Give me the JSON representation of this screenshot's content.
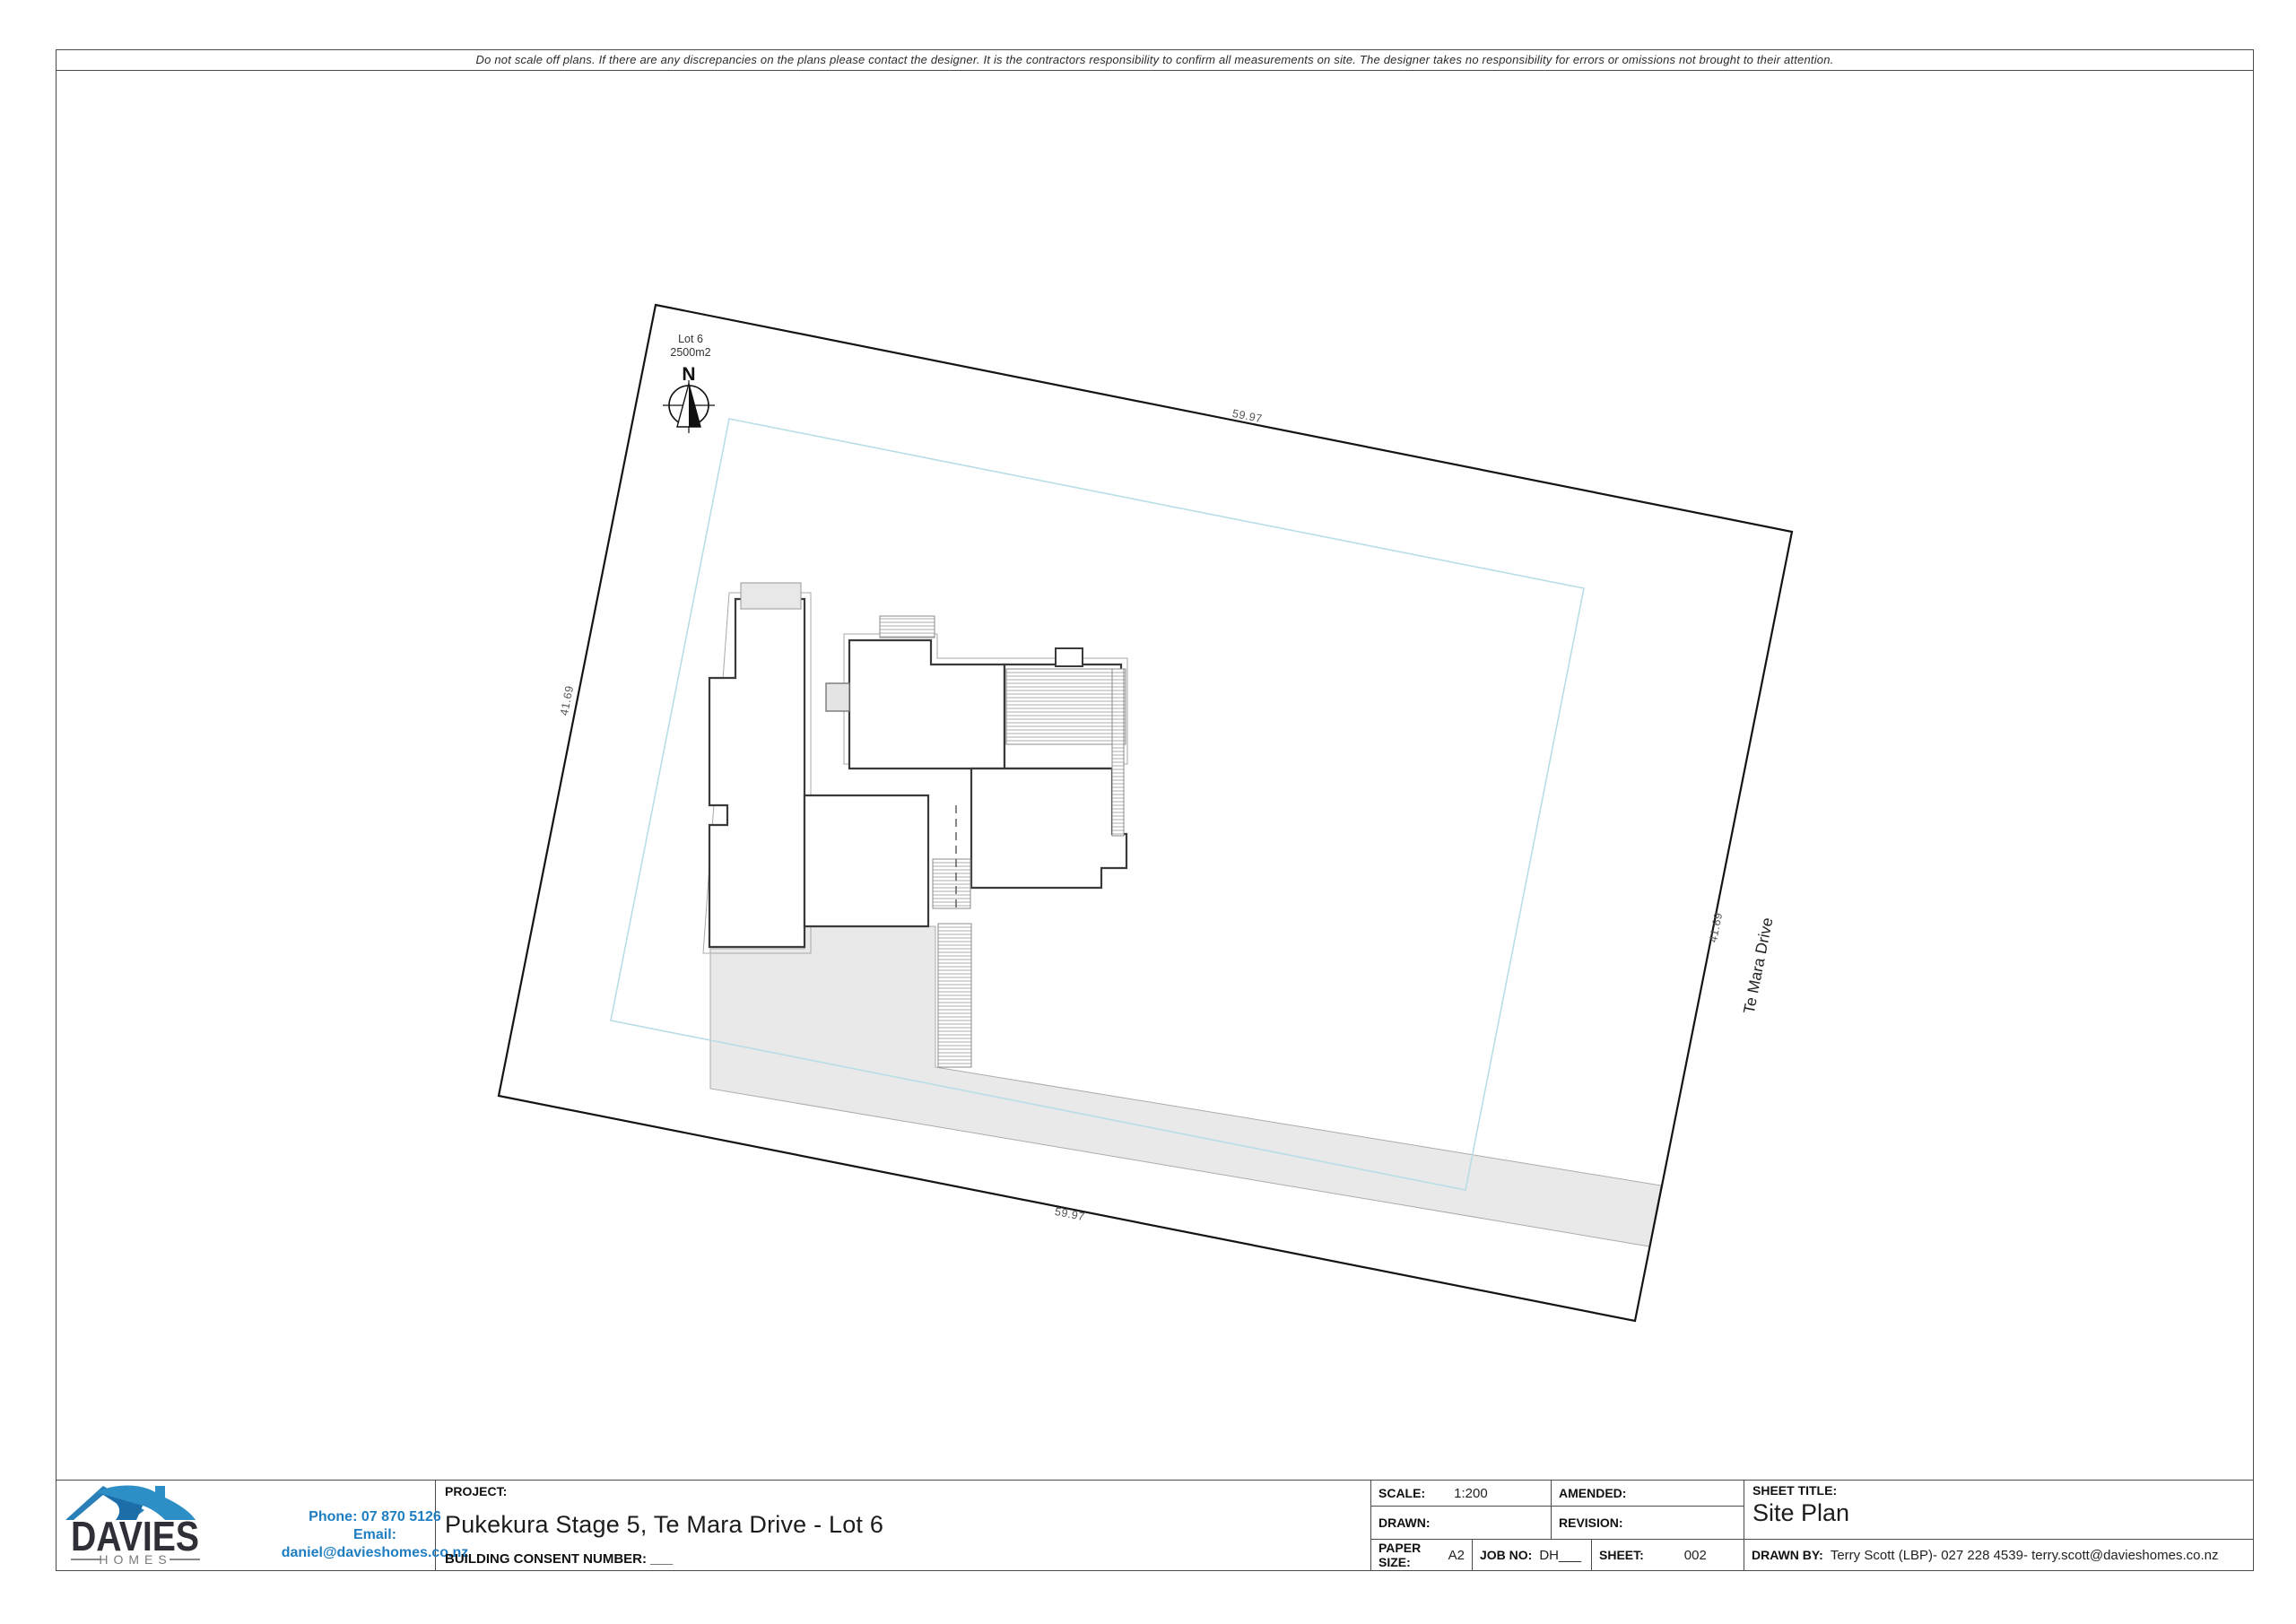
{
  "page": {
    "disclaimer": "Do not scale off plans. If there are any discrepancies on the plans please contact the designer. It is the contractors responsibility to confirm all measurements on site. The designer takes no responsibility for errors or omissions not brought to their attention."
  },
  "site_plan": {
    "lot_label": "Lot 6",
    "lot_area": "2500m2",
    "north_label": "N",
    "road_name": "Te Mara Drive",
    "dimensions": {
      "top": "59.97",
      "bottom": "59.97",
      "left": "41.69",
      "right": "41.69"
    }
  },
  "title_block": {
    "logo": {
      "name": "DAVIES",
      "sub": "HOMES",
      "phone": "Phone: 07 870 5126",
      "email": "Email: daniel@davieshomes.co.nz"
    },
    "project": {
      "label": "PROJECT:",
      "name": "Pukekura Stage 5, Te Mara Drive - Lot 6",
      "consent": "BUILDING CONSENT NUMBER: ___"
    },
    "scale": {
      "label": "SCALE:",
      "value": "1:200"
    },
    "drawn": {
      "label": "DRAWN:",
      "value": ""
    },
    "amended": {
      "label": "AMENDED:",
      "value": ""
    },
    "revision": {
      "label": "REVISION:",
      "value": ""
    },
    "paper_size": {
      "label": "PAPER SIZE:",
      "value": "A2"
    },
    "job_no": {
      "label": "JOB NO:",
      "value": "DH___"
    },
    "sheet": {
      "label": "SHEET:",
      "value": "002"
    },
    "sheet_title": {
      "label": "SHEET TITLE:",
      "value": "Site Plan"
    },
    "drawn_by": {
      "label": "DRAWN BY:",
      "value": "Terry Scott (LBP)- 027 228 4539- terry.scott@davieshomes.co.nz"
    }
  },
  "colors": {
    "contact_blue": "#1f7ec2",
    "logo_navy": "#2f2f38",
    "roof_blue": "#2e8fc7",
    "roof_blue_dark": "#1d6ea8",
    "setback_teal": "#b9dde6",
    "driveway_gray": "#e9e9e9",
    "boundary_black": "#141414"
  }
}
